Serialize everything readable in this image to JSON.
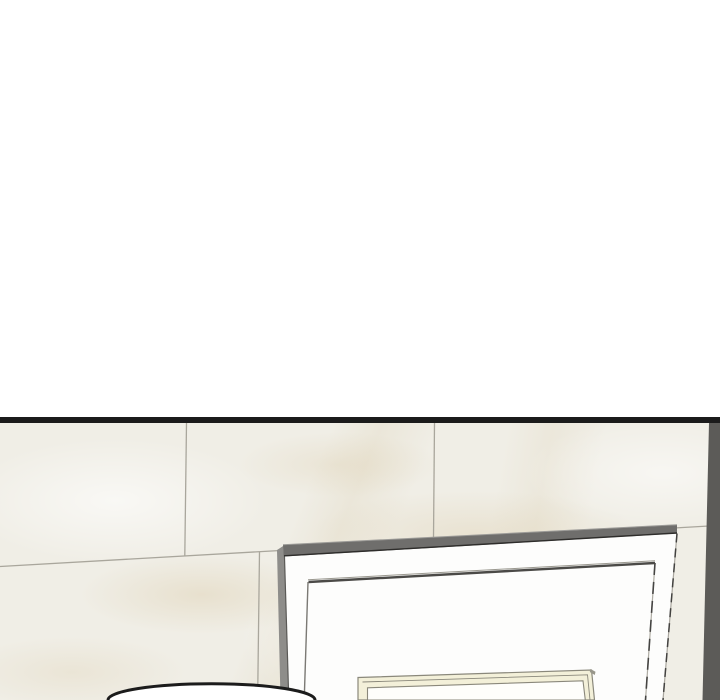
{
  "colors": {
    "gutter_white": "#ffffff",
    "panel_border_black": "#1b1b1b",
    "marble_base": "#f0eee6",
    "marble_vein_beige": "#d4c096",
    "tile_seam_gray": "#a9a69c",
    "wall_corner_shadow": "#5c5b58",
    "cabinet_face_white": "#fdfdfc",
    "cabinet_top_edge_gray": "#6f6e6c",
    "cabinet_side_gray": "#8e8d8a",
    "cabinet_edge_dark": "#2e2d2b",
    "inner_panel_edge": "#4b4a47",
    "frame_cream": "#f3f0d9",
    "frame_line_gray": "#8a887b",
    "frame_corner_shade": "#98968a",
    "frame_interior_white": "#fefefb",
    "head_fill_white": "#ffffff",
    "head_outline_black": "#1c1c1c"
  }
}
